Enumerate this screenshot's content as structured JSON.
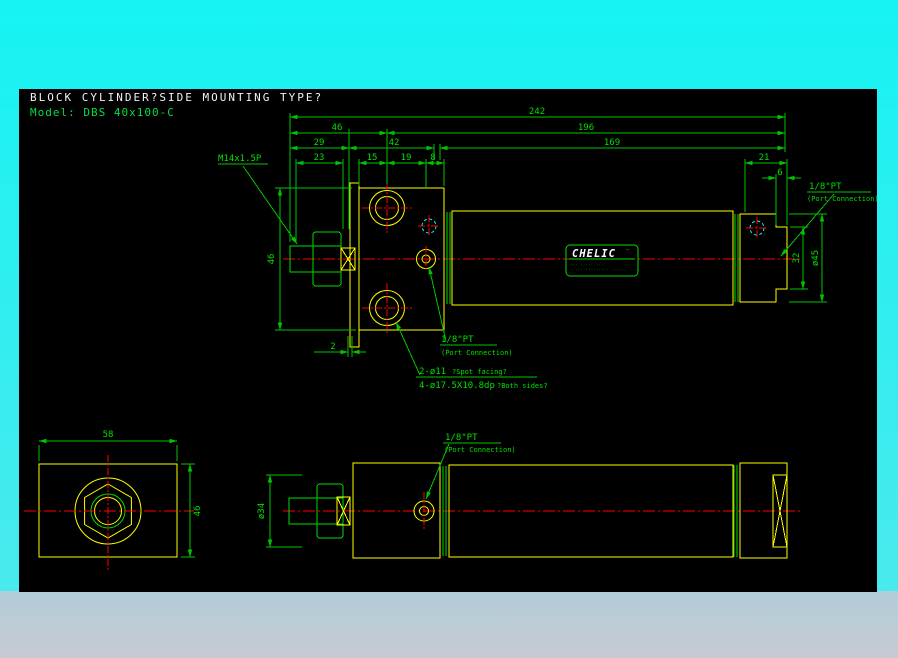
{
  "colors": {
    "background_cyan": "#1df2f2",
    "bottom_strip": "#bccbd4",
    "canvas": "#000000",
    "dimension_green": "#00c400",
    "geometry_yellow": "#ffff00",
    "geometry_green": "#00dc00",
    "centerline_red": "#ff0000",
    "hidden_cyan": "#00ffff",
    "title_white": "#f2f2f2"
  },
  "header": {
    "title": "BLOCK CYLINDER?SIDE MOUNTING TYPE?",
    "model": "Model: DBS 40x100-C"
  },
  "top_view": {
    "dims": {
      "total": "242",
      "front_group": "46",
      "body": "196",
      "rod_ext": "29",
      "block_span": "42",
      "tube_span": "169",
      "thread_len": "23",
      "hole_x": "15",
      "port_x": "19",
      "edge_x": "8",
      "cap_len": "21",
      "boss_len": "6",
      "boss_h": "32",
      "cap_dia": "ø45",
      "height": "46",
      "plate_offset": "2"
    },
    "labels": {
      "thread": "M14x1.5P",
      "port": "1/8\"PT",
      "port_sub": "(Port Connection)",
      "spot_main": "2-ø11",
      "spot_sub": "?Spot facing?",
      "cbore_main": "4-ø17.5X10.8dp",
      "cbore_sub": "?Both sides?"
    },
    "brand": {
      "name": "CHELIC",
      "mark": "™",
      "fine_line1": "··· ····· ···",
      "fine_line2": "····· ········· ······ ···"
    }
  },
  "front_view": {
    "dims": {
      "width": "58",
      "height": "46"
    }
  },
  "bottom_view": {
    "dims": {
      "rod_dia": "ø34"
    },
    "labels": {
      "port": "1/8\"PT",
      "port_sub": "(Port Connection)"
    }
  }
}
